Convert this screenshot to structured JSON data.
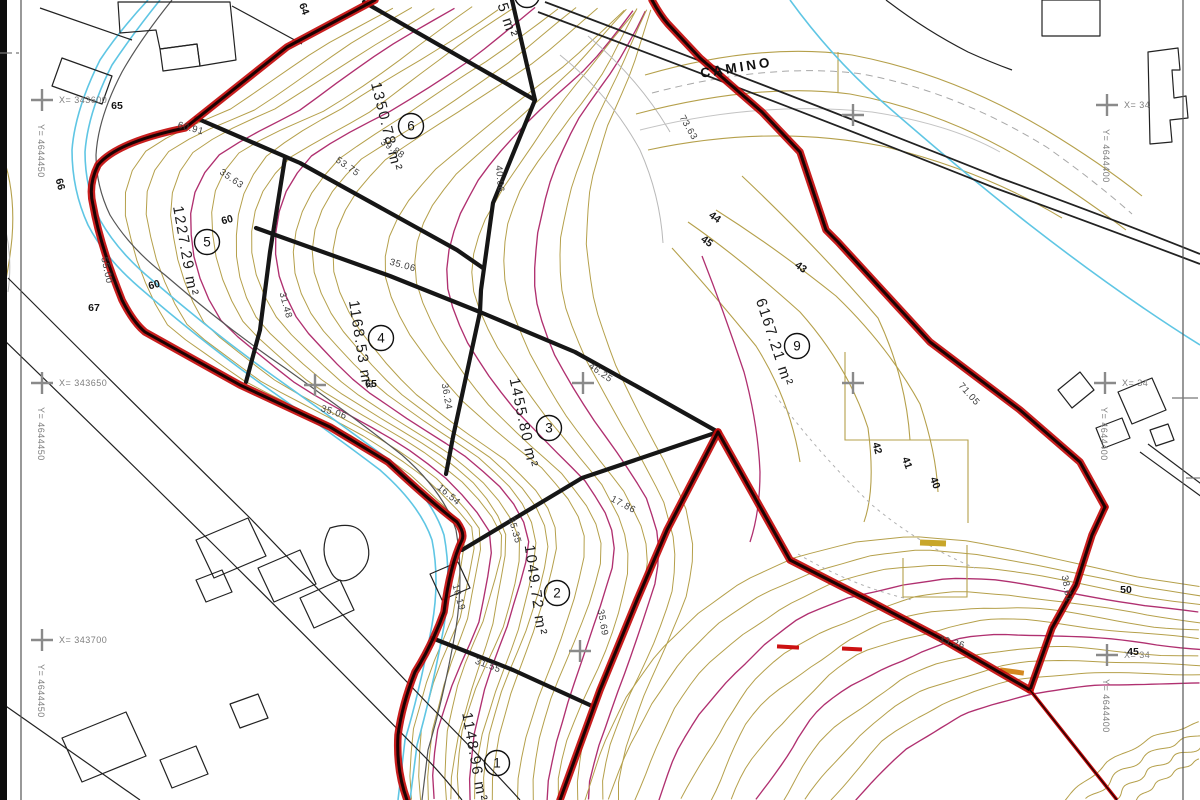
{
  "road_label": "CAMINO",
  "parcels": [
    {
      "number": "1",
      "area": "1148.96 m²",
      "cx": 497,
      "cy": 763,
      "tx": 470,
      "ty": 758,
      "rot": 80
    },
    {
      "number": "2",
      "area": "1049.72 m²",
      "cx": 557,
      "cy": 593,
      "tx": 531,
      "ty": 591,
      "rot": 82
    },
    {
      "number": "3",
      "area": "1455.80 m²",
      "cx": 549,
      "cy": 428,
      "tx": 519,
      "ty": 424,
      "rot": 78
    },
    {
      "number": "4",
      "area": "1168.53 m²",
      "cx": 381,
      "cy": 338,
      "tx": 356,
      "ty": 346,
      "rot": 81
    },
    {
      "number": "5",
      "area": "1227.29 m²",
      "cx": 207,
      "cy": 242,
      "tx": 181,
      "ty": 252,
      "rot": 80
    },
    {
      "number": "6",
      "area": "1350.78 m²",
      "cx": 411,
      "cy": 126,
      "tx": 382,
      "ty": 128,
      "rot": 76
    },
    {
      "number": "9",
      "area": "6167.21 m²",
      "cx": 797,
      "cy": 346,
      "tx": 770,
      "ty": 344,
      "rot": 72
    }
  ],
  "partial_parcel": {
    "area": "5 m²",
    "tx": 503,
    "ty": 22,
    "rot": 72,
    "cx": 527,
    "cy": -5
  },
  "elevation_labels": [
    {
      "t": "64",
      "x": 301,
      "y": 10,
      "r": 70
    },
    {
      "t": "65",
      "x": 117,
      "y": 109,
      "r": 0
    },
    {
      "t": "66",
      "x": 57,
      "y": 185,
      "r": 75
    },
    {
      "t": "67",
      "x": 94,
      "y": 311,
      "r": 0
    },
    {
      "t": "60",
      "x": 228,
      "y": 223,
      "r": -15
    },
    {
      "t": "60",
      "x": 155,
      "y": 288,
      "r": -15
    },
    {
      "t": "65",
      "x": 371,
      "y": 387,
      "r": 0
    },
    {
      "t": "44",
      "x": 713,
      "y": 220,
      "r": 35
    },
    {
      "t": "45",
      "x": 705,
      "y": 244,
      "r": 35
    },
    {
      "t": "43",
      "x": 799,
      "y": 270,
      "r": 35
    },
    {
      "t": "42",
      "x": 874,
      "y": 449,
      "r": 75
    },
    {
      "t": "41",
      "x": 904,
      "y": 464,
      "r": 70
    },
    {
      "t": "40",
      "x": 932,
      "y": 484,
      "r": 70
    },
    {
      "t": "50",
      "x": 1126,
      "y": 593,
      "r": 0
    },
    {
      "t": "45",
      "x": 1133,
      "y": 655,
      "r": 0
    }
  ],
  "dimension_labels": [
    {
      "t": "60.91",
      "x": 190,
      "y": 131,
      "r": 15
    },
    {
      "t": "55.00",
      "x": 104,
      "y": 271,
      "r": 78
    },
    {
      "t": "53.75",
      "x": 346,
      "y": 169,
      "r": 35
    },
    {
      "t": "35.63",
      "x": 230,
      "y": 181,
      "r": 35
    },
    {
      "t": "39.88",
      "x": 391,
      "y": 151,
      "r": 35
    },
    {
      "t": "40.06",
      "x": 497,
      "y": 179,
      "r": 85
    },
    {
      "t": "35.06",
      "x": 402,
      "y": 268,
      "r": 15
    },
    {
      "t": "31.48",
      "x": 283,
      "y": 306,
      "r": 75
    },
    {
      "t": "36.24",
      "x": 444,
      "y": 397,
      "r": 80
    },
    {
      "t": "46.25",
      "x": 599,
      "y": 375,
      "r": 35
    },
    {
      "t": "17.86",
      "x": 622,
      "y": 507,
      "r": 28
    },
    {
      "t": "16.54",
      "x": 447,
      "y": 497,
      "r": 40
    },
    {
      "t": "16.19",
      "x": 456,
      "y": 598,
      "r": 75
    },
    {
      "t": "35.35",
      "x": 512,
      "y": 531,
      "r": 75
    },
    {
      "t": "31.55",
      "x": 487,
      "y": 668,
      "r": 20
    },
    {
      "t": "35.69",
      "x": 600,
      "y": 623,
      "r": 80
    },
    {
      "t": "73.63",
      "x": 686,
      "y": 129,
      "r": 60
    },
    {
      "t": "71.05",
      "x": 967,
      "y": 396,
      "r": 48
    },
    {
      "t": "33.26",
      "x": 951,
      "y": 645,
      "r": 15
    },
    {
      "t": "38.61",
      "x": 1064,
      "y": 589,
      "r": 80
    },
    {
      "t": "35.06",
      "x": 333,
      "y": 415,
      "r": 18
    }
  ],
  "grid_crosses": [
    {
      "x": 42,
      "y": 100,
      "xl": "X= 343600",
      "yl": "Y= 4644450"
    },
    {
      "x": 42,
      "y": 383,
      "xl": "X= 343650",
      "yl": "Y= 4644450"
    },
    {
      "x": 42,
      "y": 640,
      "xl": "X= 343700",
      "yl": "Y= 4644450"
    },
    {
      "x": 1107,
      "y": 105,
      "xl": "X= 34",
      "yl": "Y= 4644400"
    },
    {
      "x": 1105,
      "y": 383,
      "xl": "X= 34",
      "yl": "Y= 4644400"
    },
    {
      "x": 1107,
      "y": 655,
      "xl": "X= 34",
      "yl": "Y= 4644400"
    },
    {
      "x": 315,
      "y": 385
    },
    {
      "x": 583,
      "y": 383
    },
    {
      "x": 853,
      "y": 383
    },
    {
      "x": 853,
      "y": 115
    },
    {
      "x": 580,
      "y": 651
    }
  ],
  "colors": {
    "boundary_red": "#c30b0b",
    "parcel_black": "#161616",
    "contour_tan": "#b5a04b",
    "contour_magenta": "#b03070",
    "water_cyan": "#5fc6e4",
    "grid_gray": "#8a8a8a"
  }
}
